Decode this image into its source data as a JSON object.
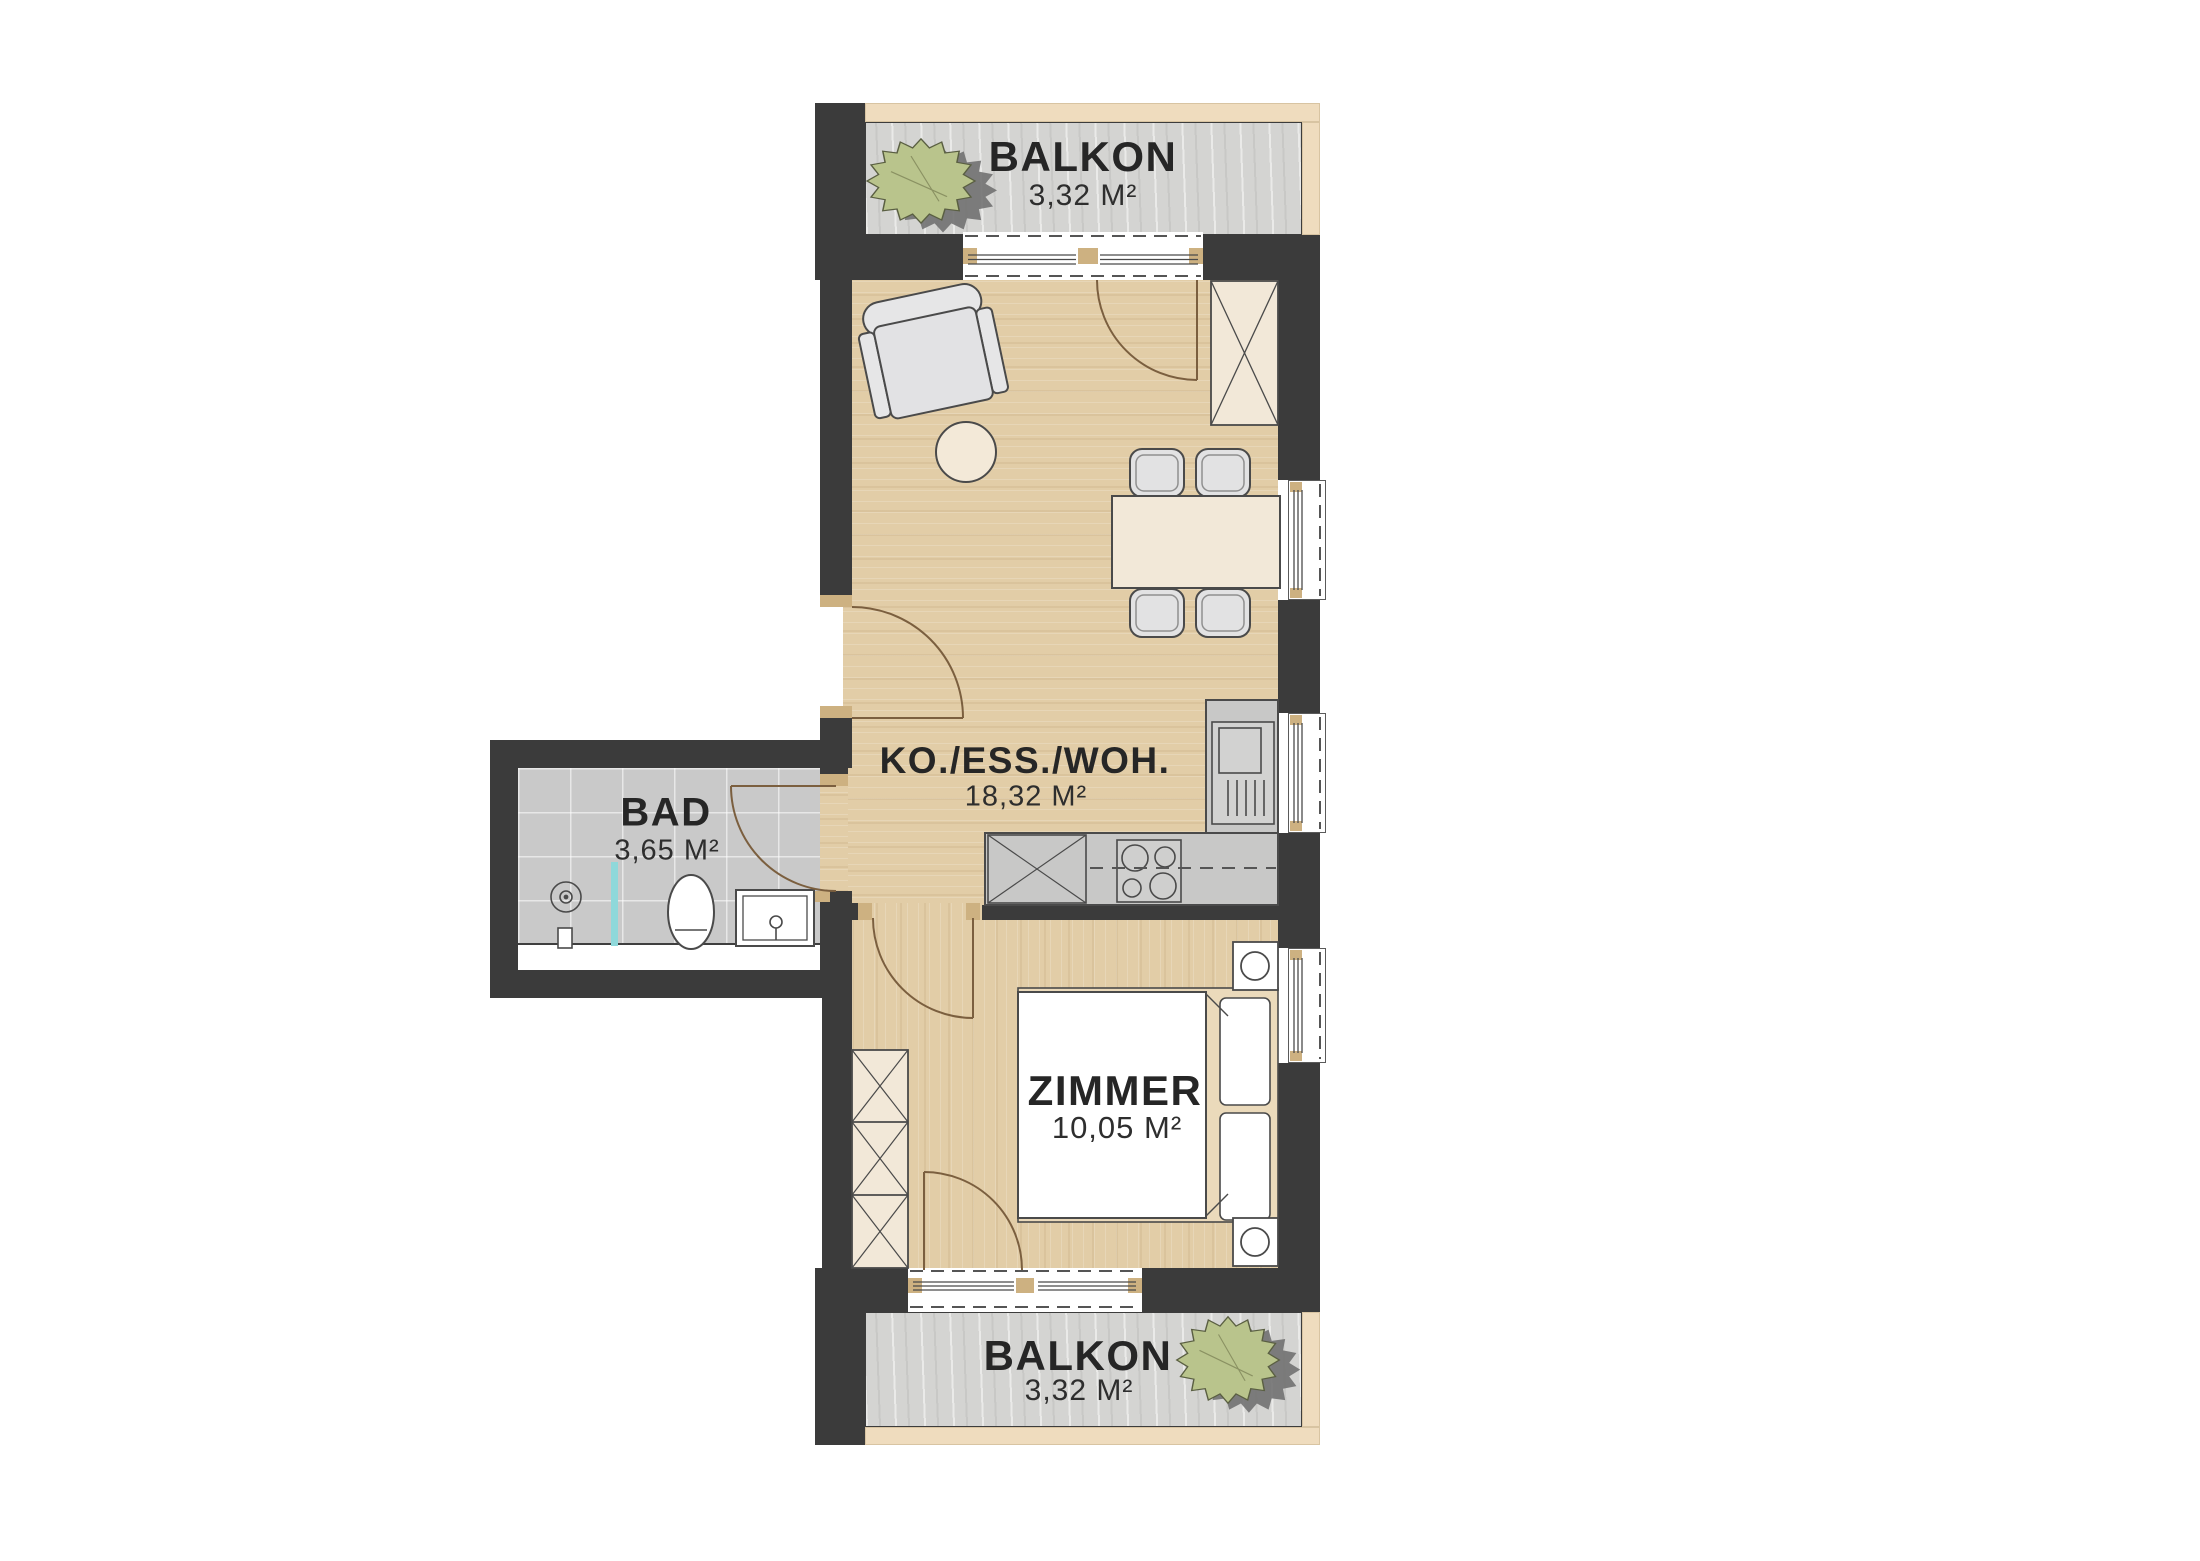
{
  "plan": {
    "rooms": [
      {
        "name": "BALKON",
        "area": "3,32 M²"
      },
      {
        "name": "KO./ESS./WOH.",
        "area": "18,32 M²"
      },
      {
        "name": "BAD",
        "area": "3,65 M²"
      },
      {
        "name": "ZIMMER",
        "area": "10,05 M²"
      },
      {
        "name": "BALKON",
        "area": "3,32 M²"
      }
    ],
    "colors": {
      "wall": "#3b3b3b",
      "floor_wood": "#e2cda7",
      "balcony_concrete": "#d4d4d2",
      "bath_tile": "#c9c9c9",
      "accent_band": "#efdcbe",
      "furniture_cream": "#f2e8d8",
      "shower_glass": "#8fd8da",
      "plant": "#b9c48c",
      "door_swing": "#7b5f3f"
    }
  }
}
